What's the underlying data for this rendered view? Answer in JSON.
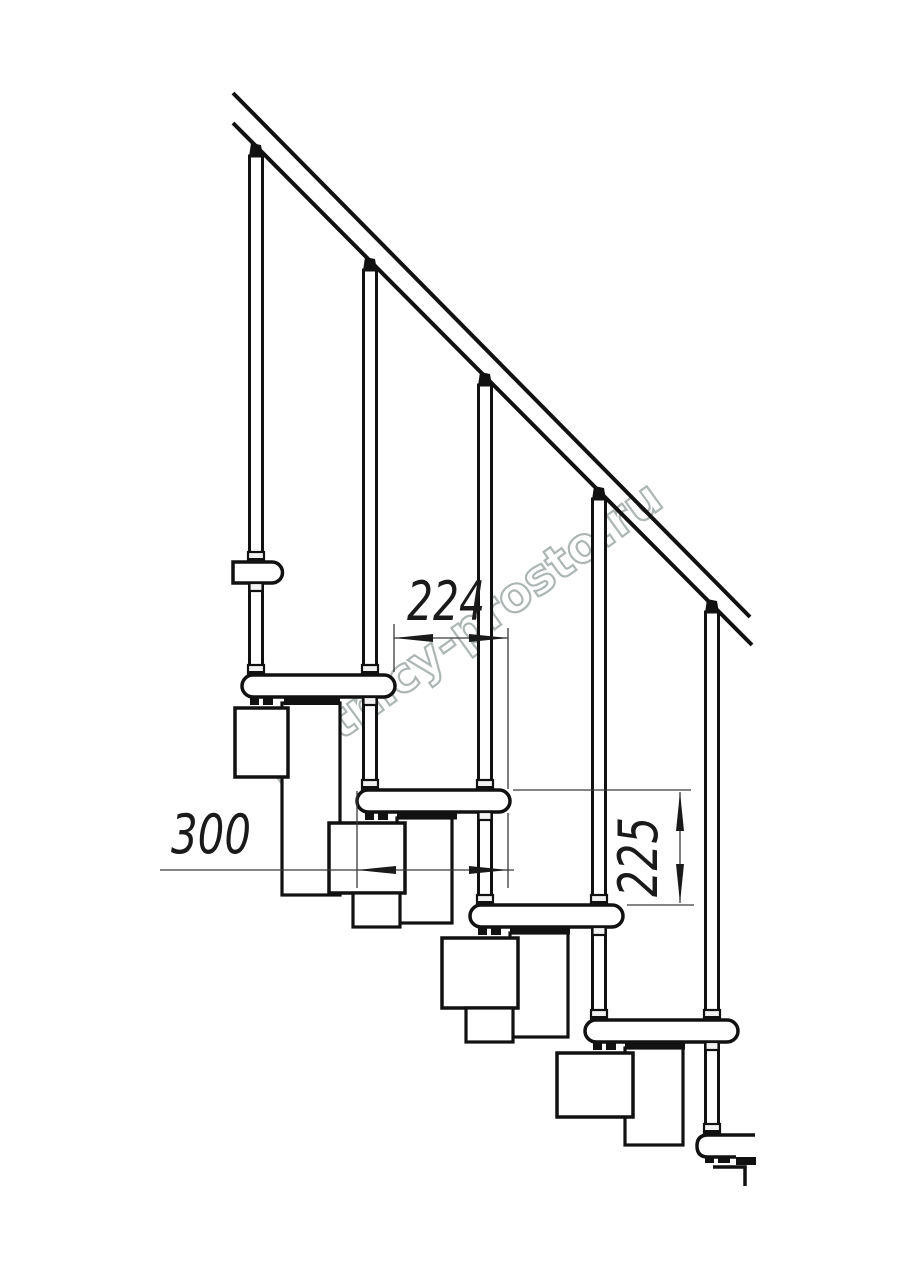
{
  "watermark": {
    "text": "lestnicy-prosto.ru",
    "color": "#b0b6b6"
  },
  "dimensions": {
    "tread_overlap": {
      "value": "224"
    },
    "tread_depth": {
      "value": "300"
    },
    "riser_height": {
      "value": "225"
    }
  },
  "drawing": {
    "line_color": "#111111",
    "dimension_line_color": "#3a3a3a",
    "background": "#ffffff"
  }
}
